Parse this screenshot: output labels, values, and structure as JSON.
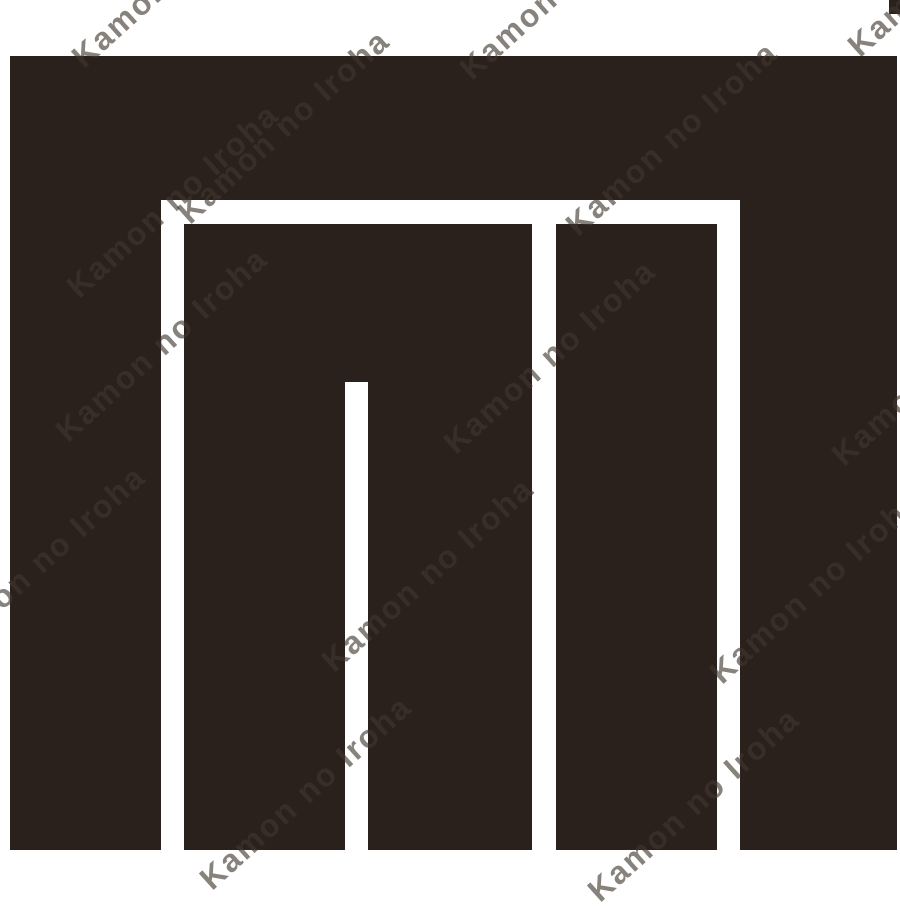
{
  "watermark": {
    "text": "Kamon no Iroha"
  },
  "colors": {
    "background": "#ffffff",
    "emblem": "#2b211c",
    "watermark": "#40372f"
  }
}
